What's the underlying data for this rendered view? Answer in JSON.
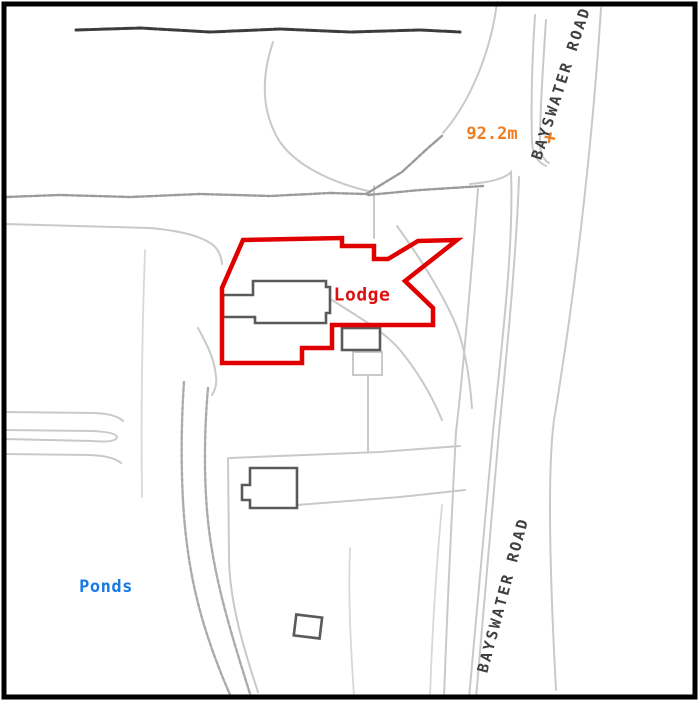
{
  "map": {
    "labels": {
      "road_top": {
        "text": "BAYSWATER ROAD"
      },
      "road_bottom": {
        "text": "BAYSWATER ROAD"
      },
      "spot_height": {
        "text": "92.2m",
        "marker_glyph": "+"
      },
      "lodge": {
        "text": "Lodge"
      },
      "ponds": {
        "text": "Ponds"
      }
    },
    "colors": {
      "boundary_red": "#e10000",
      "spot_height_orange": "#ed7d1f",
      "water_blue": "#1778e8",
      "building_stroke": "#5a5a5a",
      "map_line_gray": "#c9c9c9",
      "rough_line_gray": "#9b9b9b",
      "dark_line": "#3c3c3c",
      "road_text": "#3f3f3f",
      "frame": "#000000"
    }
  }
}
